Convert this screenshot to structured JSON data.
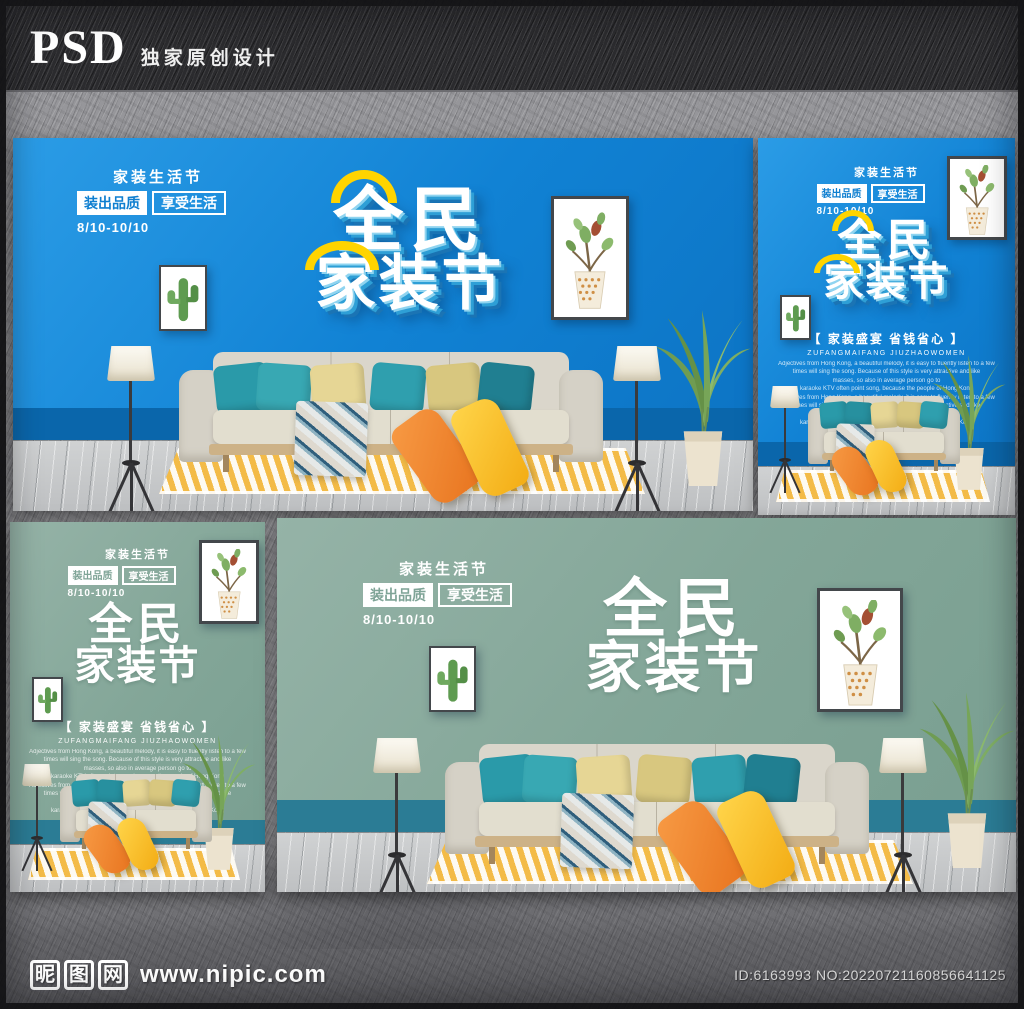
{
  "banner": {
    "psd_label": "PSD",
    "tagline": "独家原创设计"
  },
  "watermark": {
    "site_chars": [
      "昵",
      "图",
      "网"
    ],
    "site_url": "www.nipic.com",
    "image_id": "ID:6163993 NO:20220721160856641125"
  },
  "poster": {
    "header": {
      "festival": "家装生活节",
      "badge_quality": "装出品质",
      "badge_enjoy": "享受生活",
      "date_range": "8/10-10/10"
    },
    "title": {
      "line1": "全民",
      "line2": "家装节"
    },
    "caption": {
      "slogan": "【 家装盛宴  省钱省心 】",
      "subtitle": "ZUFANGMAIFANG JIUZHAOWOMEN",
      "body": "Adjectives from Hong Kong, a beautiful melody, it is easy to fluently listen to a few\ntimes will sing the song. Because of this style is very attractive and like\nmasses, so also in average person go to\nkaraoke KTV often point song, because the people of Hong Kong\nAdjectives from Hong Kong, a beautiful melody, it is easy to fluently listen to a few\ntimes will sing the song. Because of this style is very attractive and like\nmasses, so also in average person go to\nkaraoke KTV often point song, because the people of Hong Kong"
    }
  },
  "colors": {
    "poster_blue_wall": "#1182d4",
    "poster_blue_skirting": "#0a66ab",
    "poster_green_wall": "#83a698",
    "poster_green_skirting": "#2b7c95",
    "title_accent_yellow": "#ffd400",
    "rug_yellow": "#f3bb47",
    "pillow_teal": "#2f9fae",
    "pillow_khaki": "#e6d695",
    "floor_pillow_orange": "#ef8433",
    "floor_pillow_yellow": "#ffc82e",
    "sofa_fabric": "#dad6cb",
    "wood_floor": "#c7c9ca"
  }
}
